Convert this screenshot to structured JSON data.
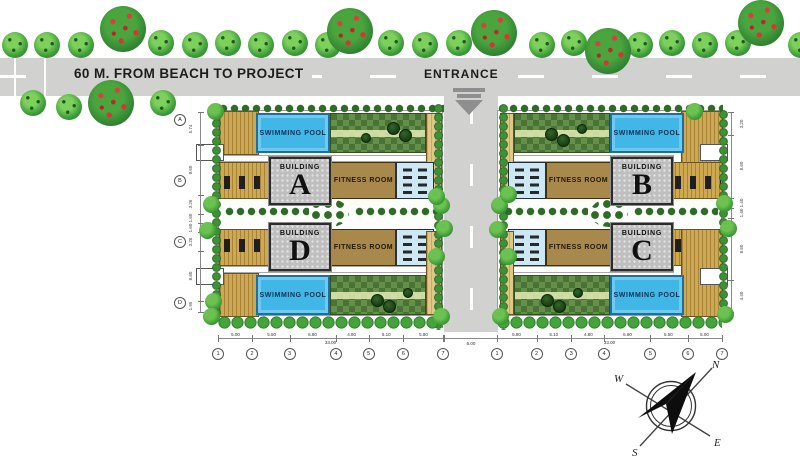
{
  "site_plan": {
    "road_label": "60 M. FROM BEACH TO PROJECT",
    "entrance_label": "ENTRANCE",
    "labels": {
      "swimming_pool": "SWIMMING POOL",
      "fitness_room": "FITNESS ROOM",
      "building": "BUILDING"
    },
    "buildings": {
      "a": "A",
      "b": "B",
      "c": "C",
      "d": "D"
    },
    "compass": {
      "n": "N",
      "e": "E",
      "s": "S",
      "w": "W"
    },
    "dimensions": {
      "bottom_left": {
        "values": [
          "5.00",
          "5.50",
          "6.80",
          "4.80",
          "5.10",
          "5.80"
        ],
        "total": "33.00",
        "bubbles": [
          "1",
          "2",
          "3",
          "4",
          "5",
          "6",
          "7"
        ]
      },
      "bottom_right": {
        "values": [
          "5.80",
          "5.10",
          "4.80",
          "6.80",
          "5.50",
          "5.00"
        ],
        "total": "33.00",
        "bubbles": [
          "1",
          "2",
          "3",
          "4",
          "5",
          "6",
          "7"
        ]
      },
      "center_road_width": "6.00",
      "left_vertical": {
        "values": [
          "5.74",
          "8.60",
          "3.26",
          "1.60",
          "1.60",
          "3.26",
          "8.60",
          "1.95"
        ],
        "bubbles": [
          "A",
          "B",
          "C",
          "D"
        ]
      },
      "right_vertical": {
        "values": [
          "3.20",
          "8.60",
          "1.40",
          "1.40",
          "8.60",
          "4.40"
        ]
      }
    },
    "colors": {
      "road": "#d1d1d0",
      "pool": "#41b7e8",
      "deck": "#cfa852",
      "fitness_room": "#a9894b",
      "garden": "#5d8743",
      "building_box": "#bfbfbf"
    }
  }
}
